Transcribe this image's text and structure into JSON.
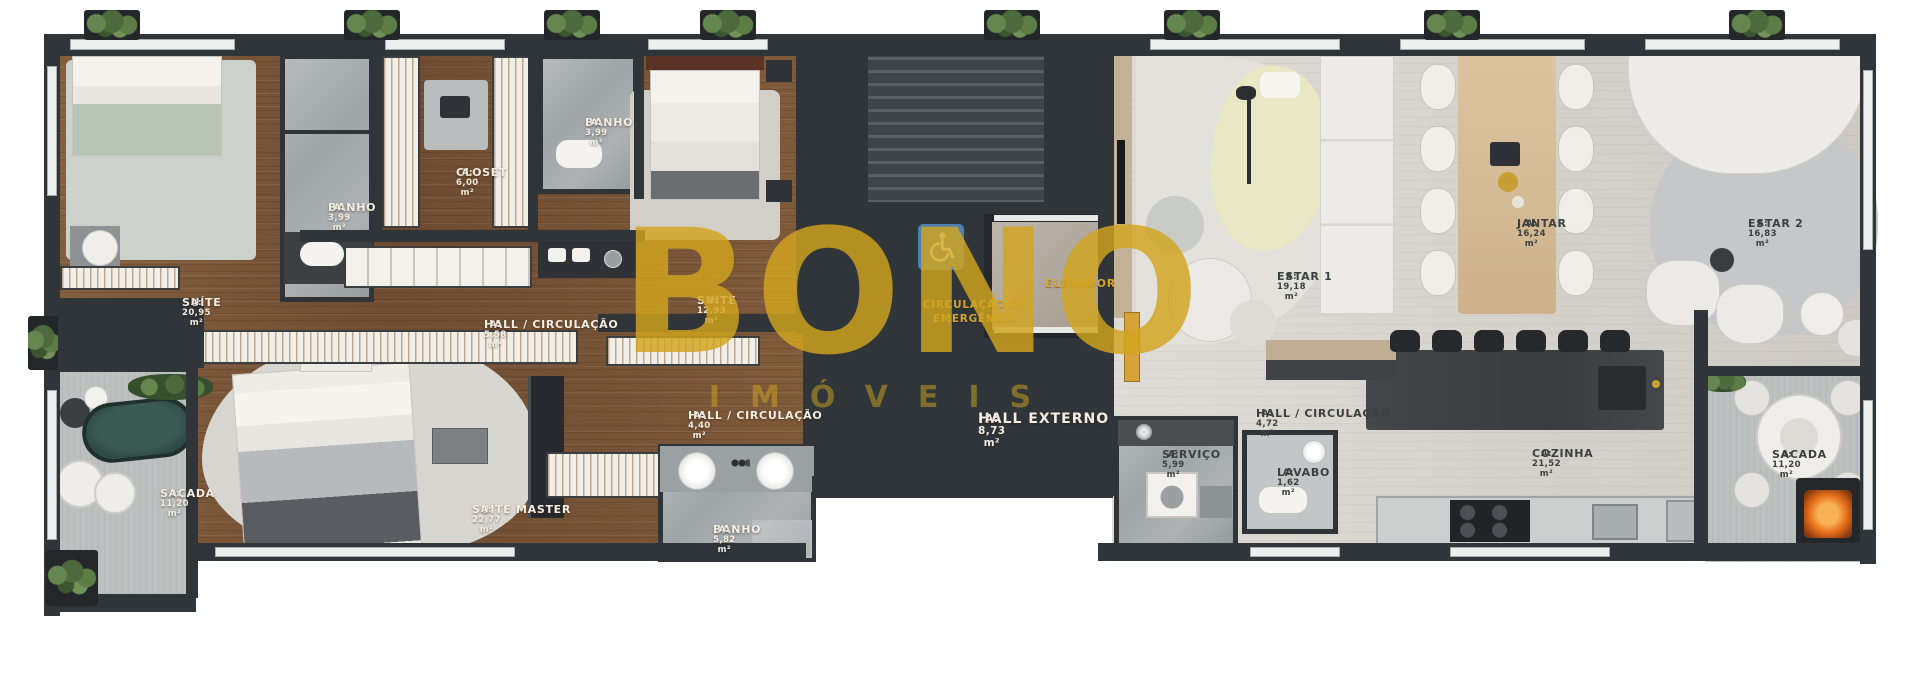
{
  "watermark": {
    "brand": "BONO",
    "brand_sub": "IMÓVEIS"
  },
  "rooms": [
    {
      "name": "SUÍTE",
      "area": "A: 20,95 m²"
    },
    {
      "name": "BANHO",
      "area": "A: 3,99 m²"
    },
    {
      "name": "CLOSET",
      "area": "A: 6,00 m²"
    },
    {
      "name": "BANHO",
      "area": "A: 3,99 m²"
    },
    {
      "name": "SUÍTE",
      "area": "A: 12,93 m²"
    },
    {
      "name": "HALL / CIRCULAÇÃO",
      "area": "A: 5,58 m²"
    },
    {
      "name": "HALL / CIRCULAÇÃO",
      "area": "A: 4,40 m²"
    },
    {
      "name": "SACADA",
      "area": "A: 11,20 m²"
    },
    {
      "name": "SUÍTE MASTER",
      "area": "A: 22,77 m²"
    },
    {
      "name": "BANHO",
      "area": "A: 5,82 m²"
    },
    {
      "name": "CIRCULAÇÃO DE EMERGÊNCIA",
      "area": ""
    },
    {
      "name": "ELEVADOR",
      "area": ""
    },
    {
      "name": "HALL EXTERNO",
      "area": "A: 8,73 m²"
    },
    {
      "name": "ESTAR 1",
      "area": "A: 19,18 m²"
    },
    {
      "name": "JANTAR",
      "area": "A: 16,24 m²"
    },
    {
      "name": "ESTAR 2",
      "area": "A: 16,83 m²"
    },
    {
      "name": "HALL / CIRCULAÇÃO",
      "area": "A: 4,72 m²"
    },
    {
      "name": "LAVABO",
      "area": "A: 1,62 m²"
    },
    {
      "name": "SERVIÇO",
      "area": "A: 5,99 m²"
    },
    {
      "name": "COZINHA",
      "area": "A: 21,52 m²"
    },
    {
      "name": "SACADA",
      "area": "A: 11,20 m²"
    }
  ],
  "icons": {
    "accessibility": "wheelchair-icon"
  },
  "colors": {
    "gold": "#D2A51F",
    "wall": "#30353A",
    "wood_floor": "#7C5437",
    "marble": "#A9AEB0",
    "stone_floor": "#D4D0C9",
    "sign_blue": "#4F7FAE",
    "flame_orange": "#E8701A"
  }
}
